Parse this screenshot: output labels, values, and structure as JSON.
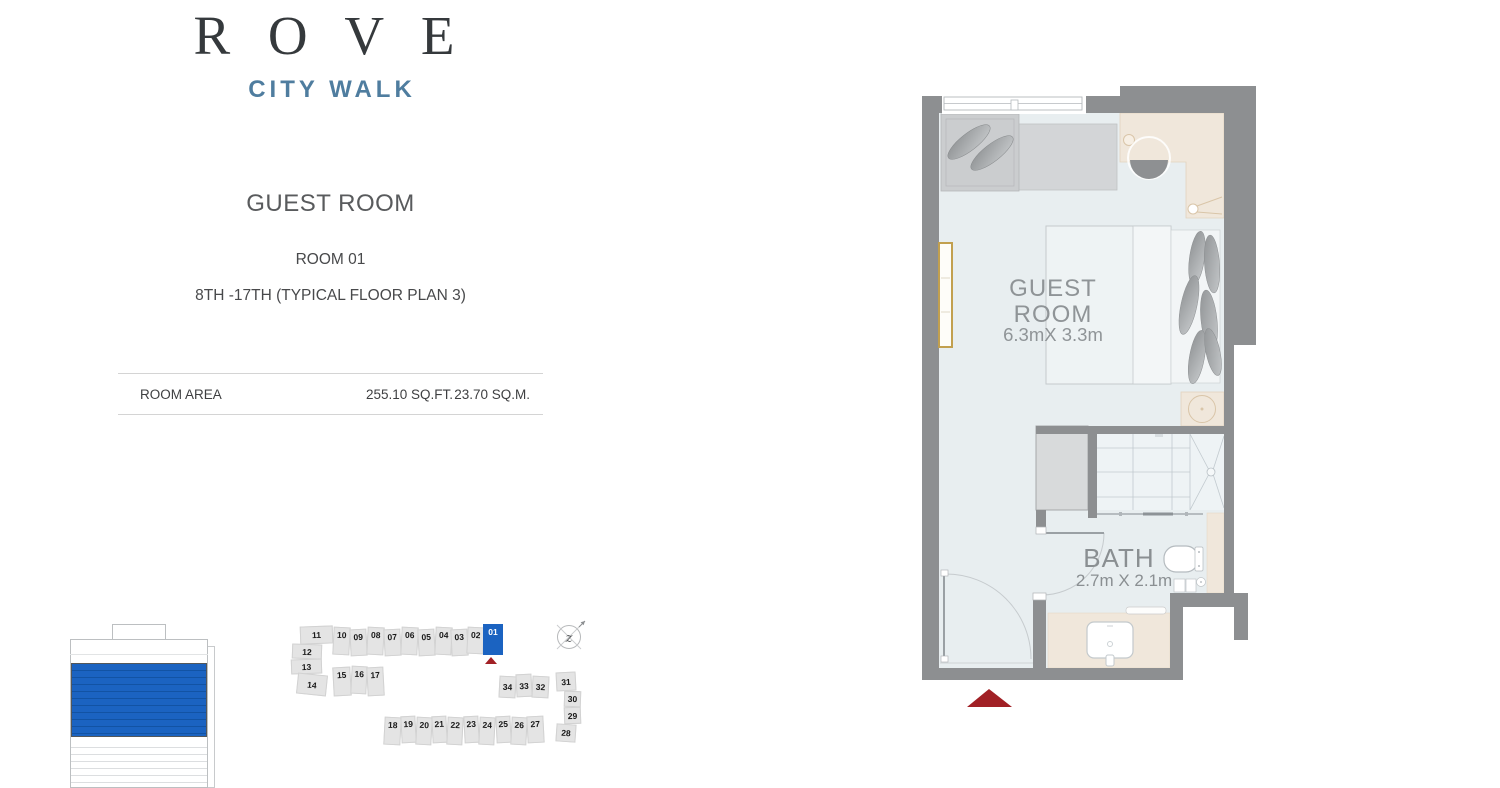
{
  "logo": {
    "title": "R O V E",
    "subtitle": "CITY WALK"
  },
  "header": {
    "room_type": "GUEST ROOM",
    "room_number": "ROOM 01",
    "floor_range": "8TH -17TH (TYPICAL FLOOR PLAN 3)"
  },
  "area_table": {
    "label": "ROOM AREA",
    "imperial": "255.10 SQ.FT.",
    "metric": "23.70 SQ.M."
  },
  "floor_plan": {
    "room_label_line1": "GUEST",
    "room_label_line2": "ROOM",
    "room_dimensions": "6.3mX 3.3m",
    "bath_label": "BATH",
    "bath_dimensions": "2.7m X 2.1m"
  },
  "key_plan": {
    "selected_unit": "01",
    "units": [
      "11",
      "10",
      "09",
      "08",
      "07",
      "06",
      "05",
      "04",
      "03",
      "02",
      "01",
      "12",
      "13",
      "14",
      "15",
      "16",
      "17",
      "34",
      "33",
      "32",
      "31",
      "30",
      "29",
      "28",
      "18",
      "19",
      "20",
      "21",
      "22",
      "23",
      "24",
      "25",
      "26",
      "27"
    ]
  },
  "compass": {
    "glyph": "z"
  },
  "colors": {
    "accent_blue": "#1b63c1",
    "wall_gray": "#8d8f91",
    "marker_red": "#a12025",
    "logo_subtitle_blue": "#4f7d9f"
  }
}
